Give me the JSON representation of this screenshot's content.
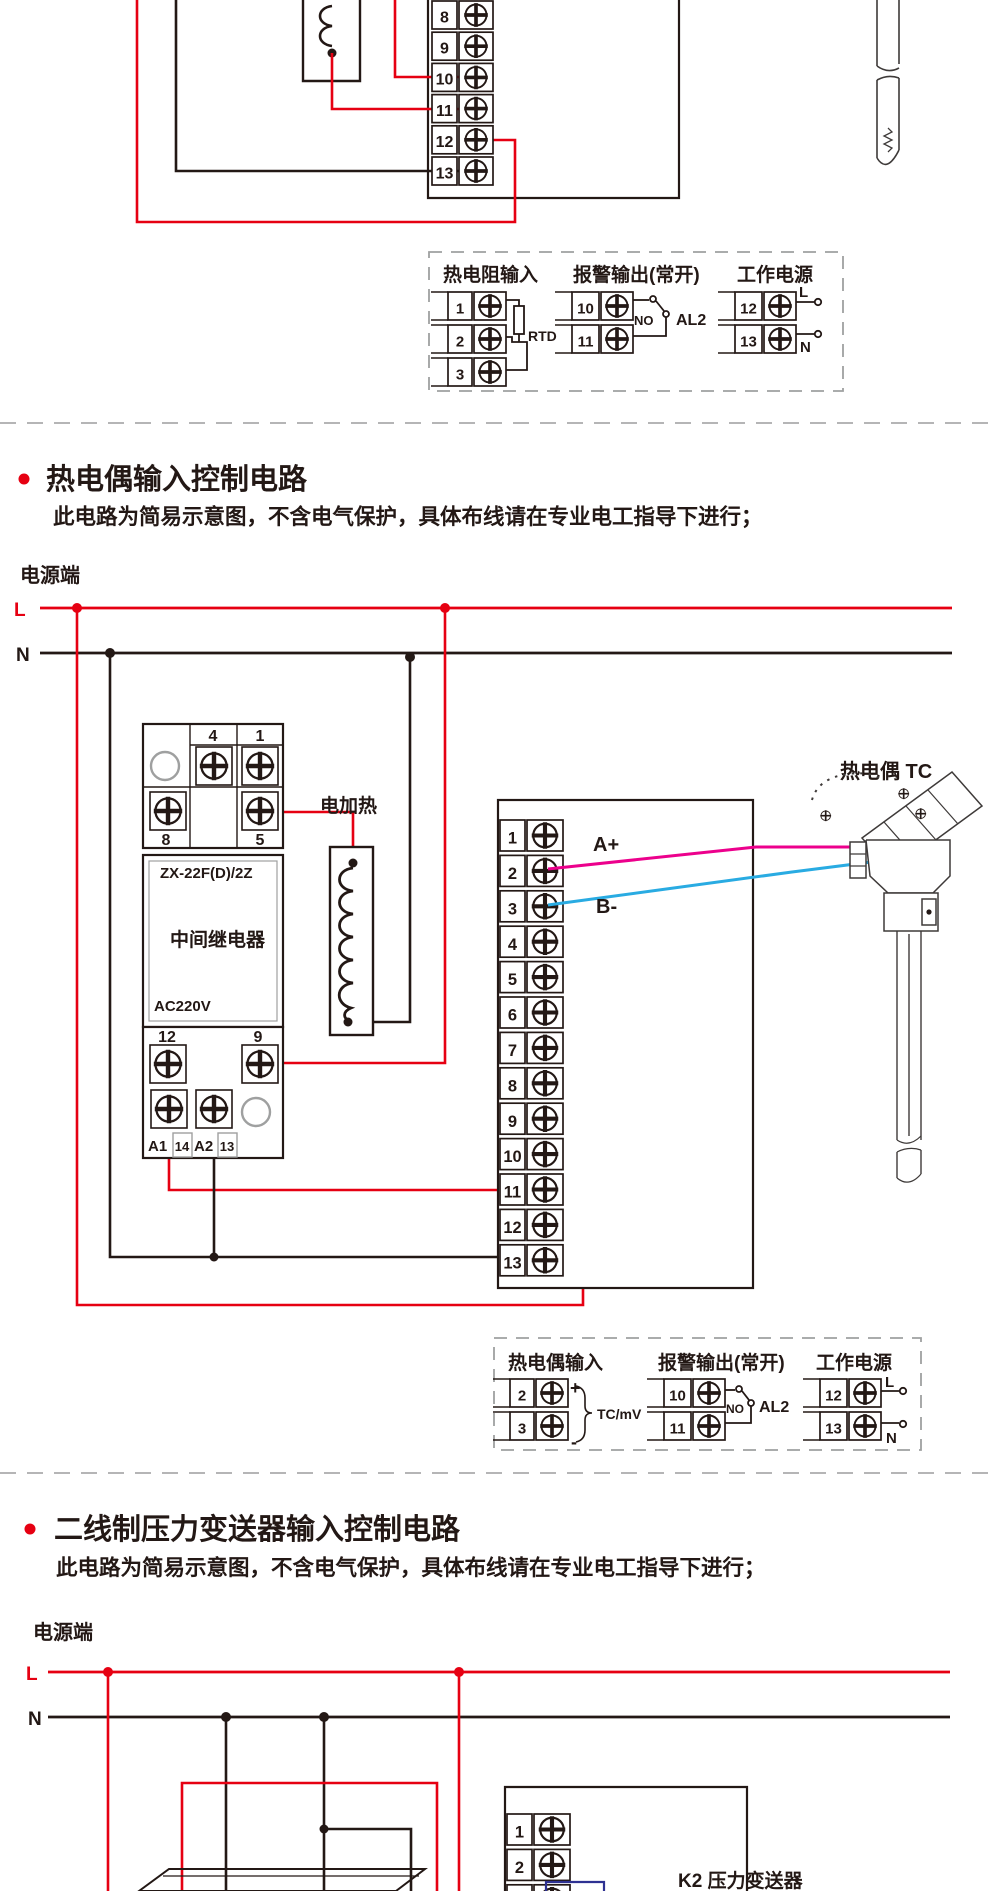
{
  "colors": {
    "red": "#e60012",
    "pink": "#ec008c",
    "blue": "#29abe2",
    "dark": "#231815",
    "gray": "#9fa0a0",
    "divider": "#b5b5b6",
    "blue_box": "#2e3192"
  },
  "partial_rtd": {
    "terminals": [
      "8",
      "9",
      "10",
      "11",
      "12",
      "13"
    ]
  },
  "legend_rtd": {
    "input_title": "热电阻输入",
    "input_terminals": [
      "1",
      "2",
      "3"
    ],
    "sensor": "RTD",
    "alarm_title": "报警输出(常开)",
    "alarm_terminals": [
      "10",
      "11"
    ],
    "contact": "NO",
    "alarm_name": "AL2",
    "power_title": "工作电源",
    "power_terminals": [
      "12",
      "13"
    ],
    "line": "L",
    "neutral": "N"
  },
  "section_tc": {
    "title": "热电偶输入控制电路",
    "subtitle": "此电路为简易示意图，不含电气保护，具体布线请在专业电工指导下进行；",
    "power_end": "电源端",
    "line": "L",
    "neutral": "N",
    "heater": "电加热",
    "relay": {
      "t4": "4",
      "t1": "1",
      "t8": "8",
      "t5": "5",
      "model": "ZX-22F(D)/2Z",
      "name": "中间继电器",
      "voltage": "AC220V",
      "t12": "12",
      "t9": "9",
      "a1": "A1",
      "n14": "14",
      "a2": "A2",
      "n13": "13"
    },
    "terminals": [
      "1",
      "2",
      "3",
      "4",
      "5",
      "6",
      "7",
      "8",
      "9",
      "10",
      "11",
      "12",
      "13"
    ],
    "wire_plus": "A+",
    "wire_minus": "B-",
    "sensor_label": "热电偶 TC"
  },
  "legend_tc": {
    "input_title": "热电偶输入",
    "input_terminals": [
      "2",
      "3"
    ],
    "plus": "+",
    "minus": "-",
    "signal": "TC/mV",
    "alarm_title": "报警输出(常开)",
    "alarm_terminals": [
      "10",
      "11"
    ],
    "contact": "NO",
    "alarm_name": "AL2",
    "power_title": "工作电源",
    "power_terminals": [
      "12",
      "13"
    ],
    "line": "L",
    "neutral": "N"
  },
  "section_pt": {
    "title": "二线制压力变送器输入控制电路",
    "subtitle": "此电路为简易示意图，不含电气保护，具体布线请在专业电工指导下进行；",
    "power_end": "电源端",
    "line": "L",
    "neutral": "N",
    "terminals": [
      "1",
      "2",
      "3"
    ],
    "device": "K2 压力变送器"
  }
}
